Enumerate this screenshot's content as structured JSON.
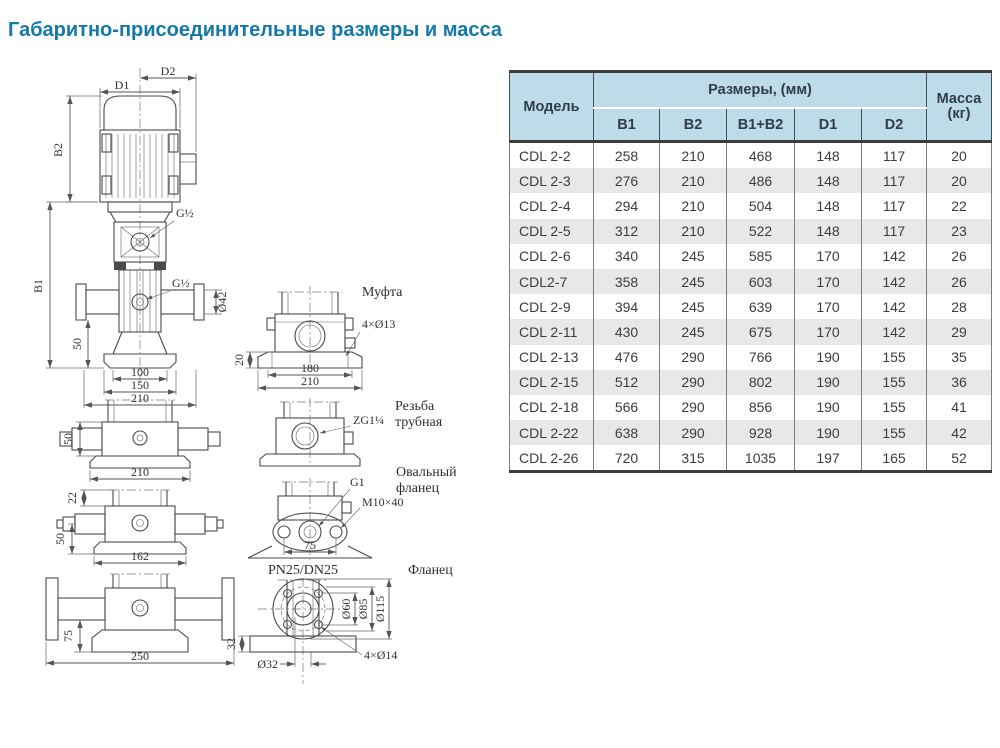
{
  "page": {
    "title": "Габаритно-присоединительные размеры и масса"
  },
  "colors": {
    "title_blue": "#1478aa",
    "table_header_bg": "#bedbea",
    "row_stripe": "#e8e8e8",
    "border_dark": "#3d3d3d"
  },
  "table": {
    "header": {
      "model": "Модель",
      "sizes_group": "Размеры, (мм)",
      "mass_line1": "Масса",
      "mass_line2": "(кг)",
      "columns": [
        "B1",
        "B2",
        "B1+B2",
        "D1",
        "D2"
      ]
    },
    "rows": [
      {
        "model": "CDL 2-2",
        "b1": "258",
        "b2": "210",
        "b1b2": "468",
        "d1": "148",
        "d2": "117",
        "mass": "20"
      },
      {
        "model": "CDL 2-3",
        "b1": "276",
        "b2": "210",
        "b1b2": "486",
        "d1": "148",
        "d2": "117",
        "mass": "20"
      },
      {
        "model": "CDL 2-4",
        "b1": "294",
        "b2": "210",
        "b1b2": "504",
        "d1": "148",
        "d2": "117",
        "mass": "22"
      },
      {
        "model": "CDL 2-5",
        "b1": "312",
        "b2": "210",
        "b1b2": "522",
        "d1": "148",
        "d2": "117",
        "mass": "23"
      },
      {
        "model": "CDL 2-6",
        "b1": "340",
        "b2": "245",
        "b1b2": "585",
        "d1": "170",
        "d2": "142",
        "mass": "26"
      },
      {
        "model": "CDL2-7",
        "b1": "358",
        "b2": "245",
        "b1b2": "603",
        "d1": "170",
        "d2": "142",
        "mass": "26"
      },
      {
        "model": "CDL 2-9",
        "b1": "394",
        "b2": "245",
        "b1b2": "639",
        "d1": "170",
        "d2": "142",
        "mass": "28"
      },
      {
        "model": "CDL 2-11",
        "b1": "430",
        "b2": "245",
        "b1b2": "675",
        "d1": "170",
        "d2": "142",
        "mass": "29"
      },
      {
        "model": "CDL 2-13",
        "b1": "476",
        "b2": "290",
        "b1b2": "766",
        "d1": "190",
        "d2": "155",
        "mass": "35"
      },
      {
        "model": "CDL 2-15",
        "b1": "512",
        "b2": "290",
        "b1b2": "802",
        "d1": "190",
        "d2": "155",
        "mass": "36"
      },
      {
        "model": "CDL 2-18",
        "b1": "566",
        "b2": "290",
        "b1b2": "856",
        "d1": "190",
        "d2": "155",
        "mass": "41"
      },
      {
        "model": "CDL 2-22",
        "b1": "638",
        "b2": "290",
        "b1b2": "928",
        "d1": "190",
        "d2": "155",
        "mass": "42"
      },
      {
        "model": "CDL 2-26",
        "b1": "720",
        "b2": "315",
        "b1b2": "1035",
        "d1": "197",
        "d2": "165",
        "mass": "52"
      }
    ]
  },
  "drawing": {
    "main": {
      "d1": "D1",
      "d2": "D2",
      "b1": "B1",
      "b2": "B2",
      "g_top": "G½",
      "g_mid": "G½",
      "dim50": "50",
      "dia42": "Ø42",
      "dim100": "100",
      "dim150": "150",
      "dim210": "210"
    },
    "view_coupling_side": {
      "dim50": "50",
      "dim210": "210"
    },
    "view_thread_side": {
      "dim22": "22",
      "dim50": "50",
      "dim162": "162"
    },
    "view_flange_side": {
      "dim75": "75",
      "dim250": "250"
    },
    "mufta": {
      "label": "Муфта",
      "callout": "4×Ø13",
      "dim20": "20",
      "dim180": "180",
      "dim210": "210"
    },
    "rezba": {
      "label1": "Резьба",
      "label2": "трубная",
      "callout": "ZG1¼"
    },
    "oval": {
      "label1": "Овальный",
      "label2": "фланец",
      "g1": "G1",
      "m10": "M10×40",
      "dim75": "75"
    },
    "flange": {
      "label": "Фланец",
      "pn": "PN25/DN25",
      "dia60": "Ø60",
      "dia85": "Ø85",
      "dia115": "Ø115",
      "dia32": "Ø32",
      "dim32": "32",
      "callout": "4×Ø14"
    }
  }
}
